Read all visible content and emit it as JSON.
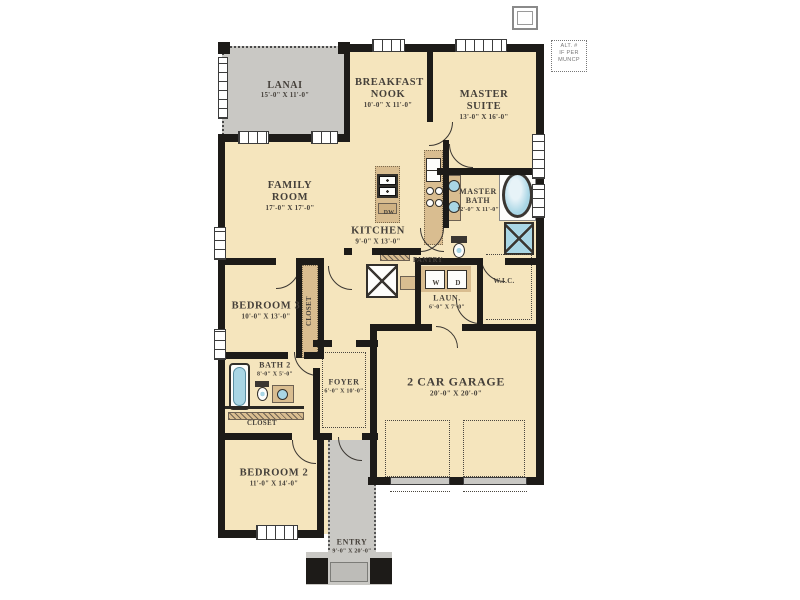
{
  "palette": {
    "wall": "#1d1b18",
    "floor": "#f5e5bd",
    "cabinet_tan": "#d9bd90",
    "outdoor_gray": "#c9c8c4",
    "fixture_blue": "#a9d6e5",
    "label_text": "#45403a"
  },
  "alt_note": {
    "line1": "ALT. #",
    "line2": "IF PER",
    "line3": "MUNCP"
  },
  "rooms": {
    "lanai": {
      "name": "LANAI",
      "dims": "15'-0\" X 11'-0\""
    },
    "breakfast_nook": {
      "name": "BREAKFAST NOOK",
      "dims": "10'-0\" X 11'-0\""
    },
    "master_suite": {
      "name": "MASTER SUITE",
      "dims": "13'-0\" X 16'-0\""
    },
    "family_room": {
      "name": "FAMILY ROOM",
      "dims": "17'-0\" X 17'-0\""
    },
    "kitchen": {
      "name": "KITCHEN",
      "dims": "9'-0\" X 13'-0\""
    },
    "master_bath": {
      "name": "MASTER BATH",
      "dims": "12'-0\" X 11'-0\""
    },
    "wic": {
      "name": "W.I.C."
    },
    "laundry": {
      "name": "LAUN.",
      "dims": "6'-0\" X 7'-0\""
    },
    "pantry": {
      "name": "PANTRY"
    },
    "bedroom3": {
      "name": "BEDROOM 3",
      "dims": "10'-0\" X 13'-0\""
    },
    "closet_bedroom3": {
      "name": "CLOSET"
    },
    "bath2": {
      "name": "BATH 2",
      "dims": "8'-0\" X 5'-0\""
    },
    "closet_hall": {
      "name": "CLOSET"
    },
    "foyer": {
      "name": "FOYER",
      "dims": "6'-0\" X 10'-0\""
    },
    "bedroom2": {
      "name": "BEDROOM 2",
      "dims": "11'-0\" X 14'-0\""
    },
    "garage": {
      "name": "2 CAR GARAGE",
      "dims": "20'-0\" X 20'-0\""
    },
    "entry": {
      "name": "ENTRY",
      "dims": "9'-0\" X 20'-0\""
    }
  },
  "appliances": {
    "washer": "W",
    "dryer": "D",
    "dishwasher": "DW"
  }
}
